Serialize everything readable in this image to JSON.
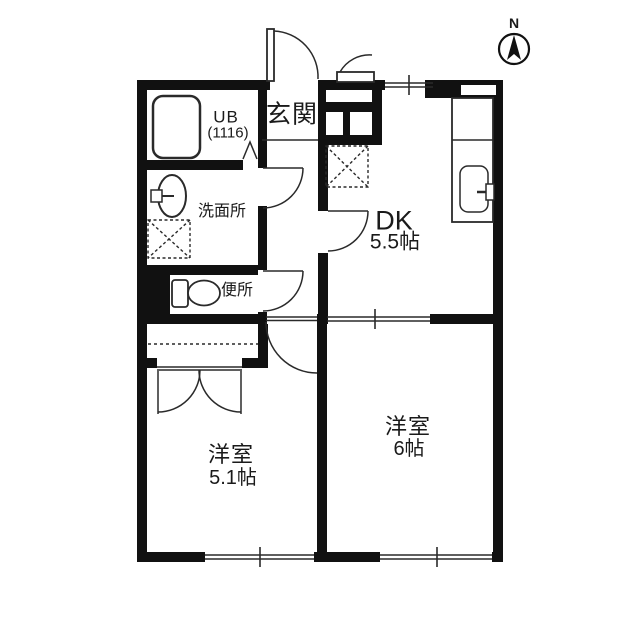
{
  "compass": {
    "north_label": "N"
  },
  "rooms": {
    "entrance": {
      "label": "玄関"
    },
    "unit_bath": {
      "label": "UB",
      "size": "(1116)"
    },
    "washroom": {
      "label": "洗面所"
    },
    "toilet": {
      "label": "便所"
    },
    "dining_kitchen": {
      "label": "DK",
      "size": "5.5帖"
    },
    "western_room_6": {
      "label": "洋室",
      "size": "6帖"
    },
    "western_room_51": {
      "label": "洋室",
      "size": "5.1帖"
    }
  },
  "fixtures": [
    "bathtub-icon",
    "washbasin-icon",
    "toilet-bowl-icon",
    "kitchen-counter-with-sink-icon",
    "washing-machine-space-dashed-box",
    "refrigerator-space-dashed-box",
    "closet-with-hanger-pole",
    "north-compass-arrow"
  ],
  "colors": {
    "wall": "#111111",
    "line": "#2a2a2a",
    "background": "#ffffff"
  }
}
